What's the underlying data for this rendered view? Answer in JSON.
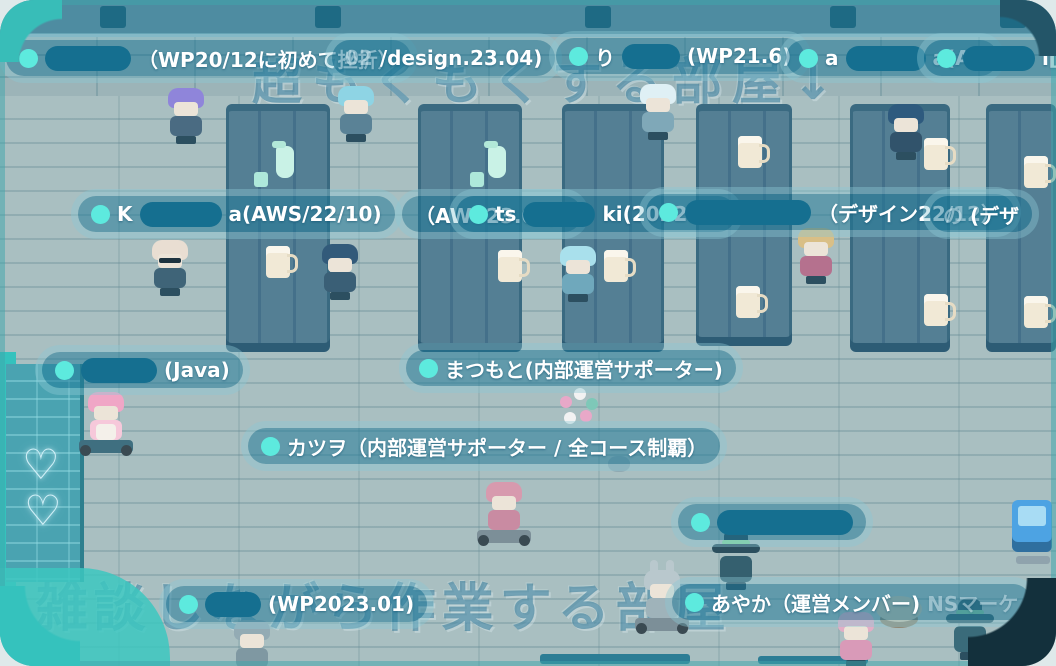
{
  "scene": {
    "background_texts": {
      "top": "超もくもくする部屋↓",
      "bottom": "←雑談しながら作業する部屋"
    },
    "colors": {
      "presence_dot": "#5deade",
      "nametag_bg": "#1e7898",
      "nametag_redaction": "#156f90",
      "floor": "#a9bfc1",
      "desk": "#547f94",
      "top_wall": "#4e8ca1",
      "left_wall": "#4aa3b1",
      "window_rim": "#38bdb8"
    },
    "top_wall_slots": [
      100,
      315,
      585,
      830,
      1000
    ],
    "hearts": [
      {
        "x": 22,
        "y": 444,
        "glyph": "♡"
      },
      {
        "x": 24,
        "y": 490,
        "glyph": "♡"
      }
    ],
    "desks": [
      {
        "x": 226,
        "y": 104,
        "w": 104,
        "h": 248
      },
      {
        "x": 418,
        "y": 104,
        "w": 104,
        "h": 248
      },
      {
        "x": 562,
        "y": 104,
        "w": 102,
        "h": 248
      },
      {
        "x": 696,
        "y": 104,
        "w": 96,
        "h": 242
      },
      {
        "x": 850,
        "y": 104,
        "w": 100,
        "h": 248
      },
      {
        "x": 986,
        "y": 104,
        "w": 70,
        "h": 248
      }
    ],
    "props": [
      {
        "kind": "pitcher",
        "x": 276,
        "y": 146
      },
      {
        "kind": "cup",
        "x": 254,
        "y": 172
      },
      {
        "kind": "pitcher",
        "x": 488,
        "y": 146
      },
      {
        "kind": "cup",
        "x": 470,
        "y": 172
      },
      {
        "kind": "mug",
        "x": 266,
        "y": 246
      },
      {
        "kind": "mug",
        "x": 498,
        "y": 250
      },
      {
        "kind": "mug",
        "x": 604,
        "y": 250
      },
      {
        "kind": "mug",
        "x": 738,
        "y": 136
      },
      {
        "kind": "mug",
        "x": 736,
        "y": 286
      },
      {
        "kind": "mug",
        "x": 924,
        "y": 138
      },
      {
        "kind": "mug",
        "x": 924,
        "y": 294
      },
      {
        "kind": "mug",
        "x": 1024,
        "y": 156
      },
      {
        "kind": "mug",
        "x": 1024,
        "y": 296
      },
      {
        "kind": "flowers",
        "x": 556,
        "y": 386
      },
      {
        "kind": "stool",
        "x": 876,
        "y": 596
      },
      {
        "kind": "blob",
        "x": 608,
        "y": 456
      },
      {
        "kind": "bar",
        "x": 540,
        "y": 654,
        "w": 150,
        "h": 10
      },
      {
        "kind": "bar",
        "x": 758,
        "y": 656,
        "w": 110,
        "h": 8
      }
    ],
    "avatars": [
      {
        "name": "avatar-purple-hair",
        "kind": "person",
        "x": 164,
        "y": 86,
        "hair": "#8f85da",
        "body": "#4a6b82"
      },
      {
        "name": "avatar-aqua-cap",
        "kind": "person",
        "x": 334,
        "y": 84,
        "hair": "#8ed4e4",
        "body": "#5a8296"
      },
      {
        "name": "avatar-white-beanie",
        "kind": "person",
        "x": 636,
        "y": 82,
        "hair": "#dff0f5",
        "body": "#7fa8b8"
      },
      {
        "name": "avatar-navy-hair",
        "kind": "person",
        "x": 884,
        "y": 102,
        "hair": "#2e5a7e",
        "body": "#31536b"
      },
      {
        "name": "avatar-bald-glasses",
        "kind": "person",
        "x": 148,
        "y": 238,
        "hair": "#e9ded2",
        "body": "#3f6478",
        "glasses": true
      },
      {
        "name": "avatar-darkblue-hair",
        "kind": "person",
        "x": 318,
        "y": 242,
        "hair": "#325a7a",
        "body": "#3a5f76"
      },
      {
        "name": "avatar-blue-curly",
        "kind": "person",
        "x": 556,
        "y": 244,
        "hair": "#a9e0ec",
        "body": "#6fa8bc"
      },
      {
        "name": "avatar-blonde-curly",
        "kind": "person",
        "x": 794,
        "y": 226,
        "hair": "#d9bf86",
        "body": "#b5718e"
      },
      {
        "name": "avatar-pink-dress",
        "kind": "person",
        "x": 84,
        "y": 390,
        "hair": "#f0a6c6",
        "body": "#f6c8da",
        "apron": true,
        "kart": true,
        "kartColor": "#3f6f80"
      },
      {
        "name": "avatar-pink-kart-rider",
        "kind": "person",
        "x": 482,
        "y": 480,
        "hair": "#d79aae",
        "body": "#c98ba2",
        "kart": true
      },
      {
        "name": "avatar-rabbit-kart",
        "kind": "person",
        "x": 640,
        "y": 568,
        "hair": "#b9c8cd",
        "body": "#9fb3ba",
        "ears": true,
        "kart": true
      },
      {
        "name": "avatar-witch",
        "kind": "witch",
        "x": 714,
        "y": 532,
        "hat": "#2c4f5e",
        "band": "#7fd49a",
        "body": "#35606f"
      },
      {
        "name": "avatar-blue-machine",
        "kind": "machine",
        "x": 1010,
        "y": 500
      },
      {
        "name": "avatar-gray-bottom",
        "kind": "person",
        "x": 230,
        "y": 618,
        "hair": "#93abb4",
        "body": "#7f98a2"
      },
      {
        "name": "avatar-pink-bottom",
        "kind": "person",
        "x": 834,
        "y": 610,
        "hair": "#e2aec6",
        "body": "#d99ab8"
      },
      {
        "name": "avatar-witchhat-bottom",
        "kind": "witch",
        "x": 948,
        "y": 602,
        "hat": "#35606f",
        "band": "#88c9a0",
        "body": "#3a6b7a"
      }
    ],
    "labels": [
      {
        "name": "nametag-anon-wp2012",
        "x": 6,
        "y": 40,
        "dot": true,
        "segments": [
          {
            "redact": 86
          },
          {
            "text": "（WP20/12に初めて挫折）"
          }
        ]
      },
      {
        "name": "nametag-design-2304",
        "x": 332,
        "y": 40,
        "dot": false,
        "segments": [
          {
            "text": "02",
            "dim": true
          },
          {
            "text": "/design.23.04)"
          }
        ]
      },
      {
        "name": "nametag-anon-wp216",
        "x": 556,
        "y": 38,
        "dot": true,
        "segments": [
          {
            "text": "り"
          },
          {
            "redact": 58
          },
          {
            "text": "(WP21.6)"
          }
        ]
      },
      {
        "name": "nametag-anon-av",
        "x": 786,
        "y": 40,
        "dot": true,
        "segments": [
          {
            "text": "a"
          },
          {
            "redact": 80
          },
          {
            "text": "a(AV"
          }
        ]
      },
      {
        "name": "nametag-anon-ki",
        "x": 924,
        "y": 40,
        "dot": true,
        "segments": [
          {
            "redact": 72
          },
          {
            "text": "i[L"
          }
        ]
      },
      {
        "name": "nametag-k-aws",
        "x": 78,
        "y": 196,
        "dot": true,
        "segments": [
          {
            "text": "K"
          },
          {
            "redact": 82
          },
          {
            "text": "a(AWS/22/10)"
          }
        ]
      },
      {
        "name": "nametag-aws2302",
        "x": 402,
        "y": 196,
        "dot": false,
        "segments": [
          {
            "text": "（AWS23.02）"
          }
        ]
      },
      {
        "name": "nametag-ts-ki",
        "x": 456,
        "y": 196,
        "dot": true,
        "segments": [
          {
            "text": "ts"
          },
          {
            "redact": 72
          },
          {
            "text": "ki(2022.12"
          }
        ]
      },
      {
        "name": "nametag-anon-design2212",
        "x": 646,
        "y": 194,
        "dot": true,
        "segments": [
          {
            "redact": 126
          },
          {
            "text": "（デザイン22/12）"
          }
        ]
      },
      {
        "name": "nametag-no-design",
        "x": 930,
        "y": 196,
        "dot": false,
        "segments": [
          {
            "text": "の",
            "dim": true
          },
          {
            "text": "(デザ"
          }
        ]
      },
      {
        "name": "nametag-anon-java",
        "x": 42,
        "y": 352,
        "dot": true,
        "segments": [
          {
            "redact": 76
          },
          {
            "text": "(Java)"
          }
        ]
      },
      {
        "name": "nametag-matsumoto",
        "x": 406,
        "y": 350,
        "dot": true,
        "segments": [
          {
            "text": "まつもと(内部運営サポーター)"
          }
        ]
      },
      {
        "name": "nametag-katsuwo",
        "x": 248,
        "y": 428,
        "dot": true,
        "segments": [
          {
            "text": "カツヲ（内部運営サポーター / 全コース制覇）"
          }
        ]
      },
      {
        "name": "nametag-anon-only",
        "x": 678,
        "y": 504,
        "dot": true,
        "segments": [
          {
            "redact": 136
          }
        ]
      },
      {
        "name": "nametag-anon-wp202301",
        "x": 166,
        "y": 586,
        "dot": true,
        "segments": [
          {
            "redact": 56
          },
          {
            "text": "(WP2023.01)"
          }
        ]
      },
      {
        "name": "nametag-ayaka",
        "x": 672,
        "y": 584,
        "dot": true,
        "segments": [
          {
            "text": "あやか（運営メンバー)"
          },
          {
            "text": "NSマーケ",
            "dim": true
          }
        ]
      }
    ]
  }
}
